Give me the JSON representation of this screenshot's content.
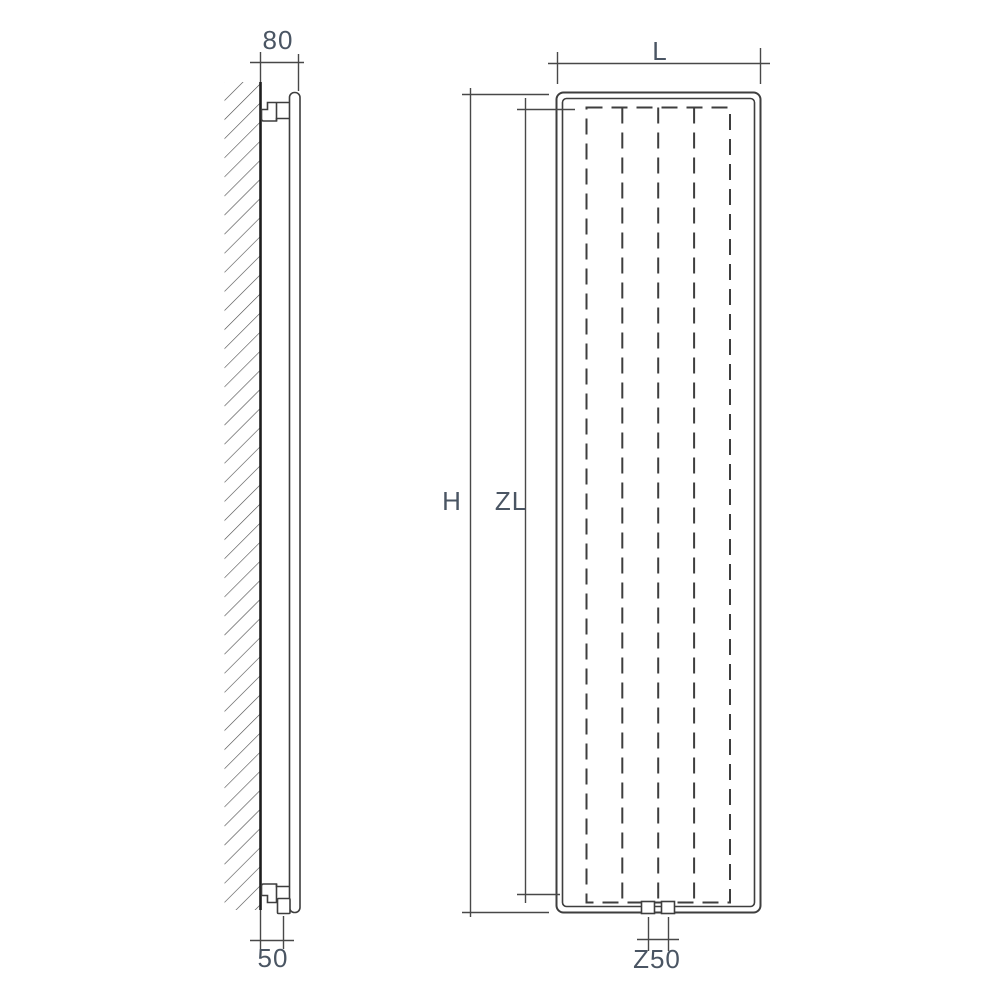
{
  "drawing": {
    "kind": "radiator dimension diagram, side view and front view",
    "labels": {
      "side_top_offset": "80",
      "side_bottom_offset": "50",
      "front_width": "L",
      "front_height": "H",
      "front_inner_height": "ZL",
      "front_connection_spacing": "Z50"
    },
    "colors": {
      "line": "#3e3e3e",
      "wall_line": "#1e1e1e",
      "hatch": "#4a4a4a",
      "label_text": "#4a5563",
      "background": "#ffffff"
    }
  }
}
